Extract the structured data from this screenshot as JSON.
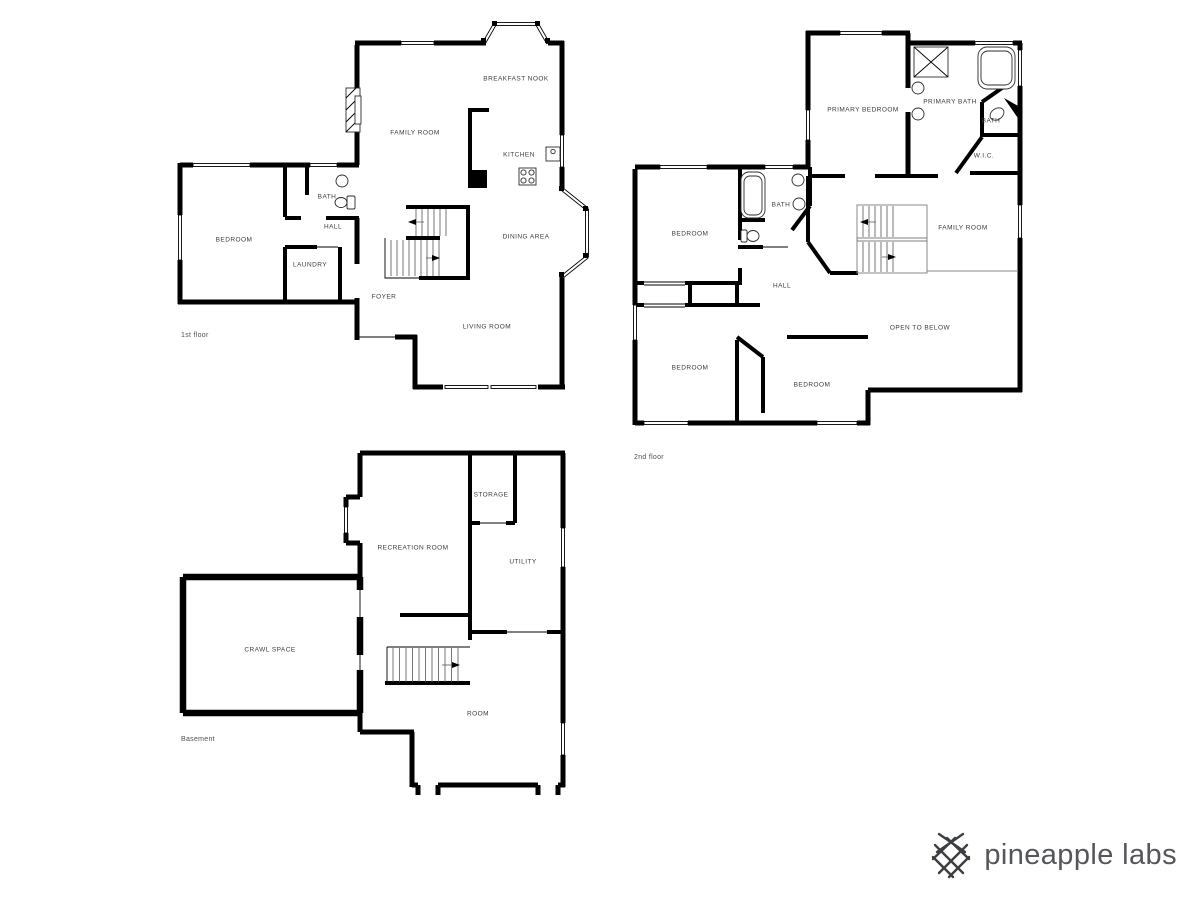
{
  "brand": {
    "name": "pineapple labs",
    "icon": "crosshatch-lattice",
    "text_color": "#54565a"
  },
  "colors": {
    "background": "#ffffff",
    "wall": "#000000",
    "label": "#3b3b3b",
    "floor_title": "#4f4f4f"
  },
  "floors": {
    "first": {
      "title": "1st floor",
      "rooms": [
        {
          "label": "BREAKFAST NOOK"
        },
        {
          "label": "FAMILY ROOM"
        },
        {
          "label": "KITCHEN"
        },
        {
          "label": "BATH"
        },
        {
          "label": "HALL"
        },
        {
          "label": "BEDROOM"
        },
        {
          "label": "LAUNDRY"
        },
        {
          "label": "DINING AREA"
        },
        {
          "label": "FOYER"
        },
        {
          "label": "LIVING ROOM"
        }
      ]
    },
    "second": {
      "title": "2nd floor",
      "rooms": [
        {
          "label": "PRIMARY BEDROOM"
        },
        {
          "label": "PRIMARY BATH"
        },
        {
          "label": "BATH"
        },
        {
          "label": "W.I.C."
        },
        {
          "label": "BEDROOM"
        },
        {
          "label": "BATH"
        },
        {
          "label": "HALL"
        },
        {
          "label": "FAMILY ROOM"
        },
        {
          "label": "OPEN TO BELOW"
        },
        {
          "label": "BEDROOM"
        },
        {
          "label": "BEDROOM"
        }
      ]
    },
    "basement": {
      "title": "Basement",
      "rooms": [
        {
          "label": "STORAGE"
        },
        {
          "label": "RECREATION ROOM"
        },
        {
          "label": "UTILITY"
        },
        {
          "label": "CRAWL SPACE"
        },
        {
          "label": "ROOM"
        }
      ]
    }
  }
}
